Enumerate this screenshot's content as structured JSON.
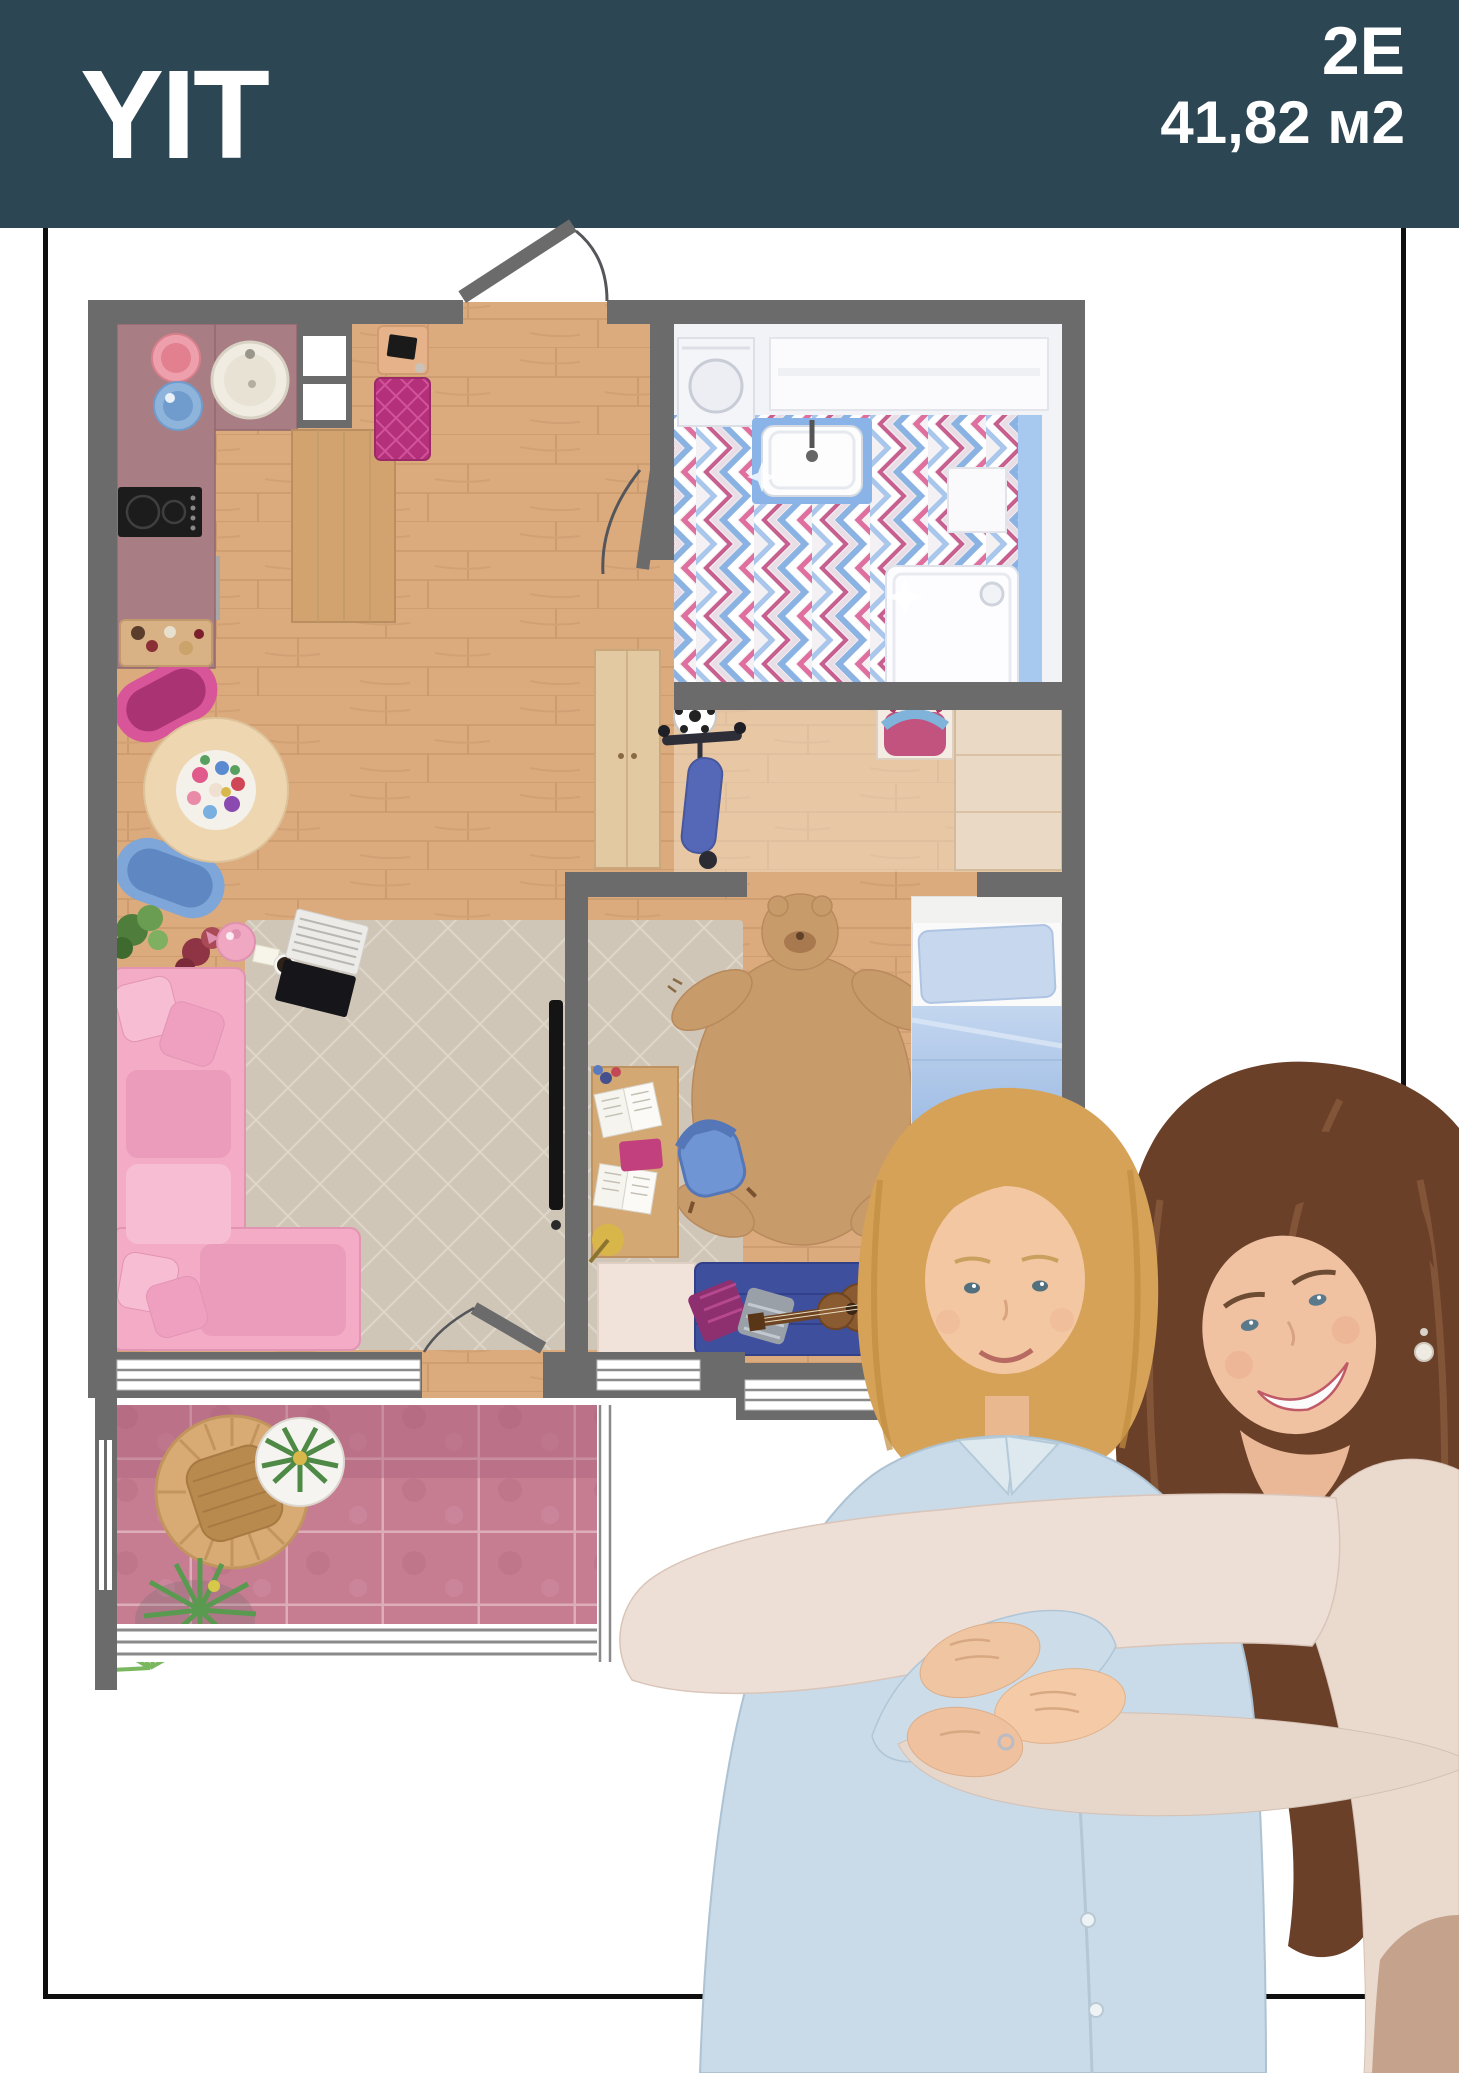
{
  "header": {
    "logo_text": "YIT",
    "plan_code": "2E",
    "area_label": "41,82 м2",
    "background": "#2d4653",
    "text_color": "#ffffff"
  },
  "palette": {
    "frame": "#0e0e0e",
    "wall": "#6b6b6b",
    "wood_floor": "#dcab7d",
    "kitchen_counter": "#a87e84",
    "bathroom_blue": "#8ab4e8",
    "balcony_tile": "#c67d92",
    "sofa_pink": "#f3abc6",
    "bed_blue": "#6f9bd6",
    "rug_beige": "#cfc6b8",
    "bench_magenta": "#b5307b"
  },
  "floorplan": {
    "rooms": [
      {
        "name": "kitchen"
      },
      {
        "name": "living-room"
      },
      {
        "name": "entry-hall"
      },
      {
        "name": "bathroom"
      },
      {
        "name": "hallway"
      },
      {
        "name": "bedroom"
      },
      {
        "name": "balcony"
      }
    ]
  },
  "photo": {
    "subject": "mother-hugging-child"
  }
}
